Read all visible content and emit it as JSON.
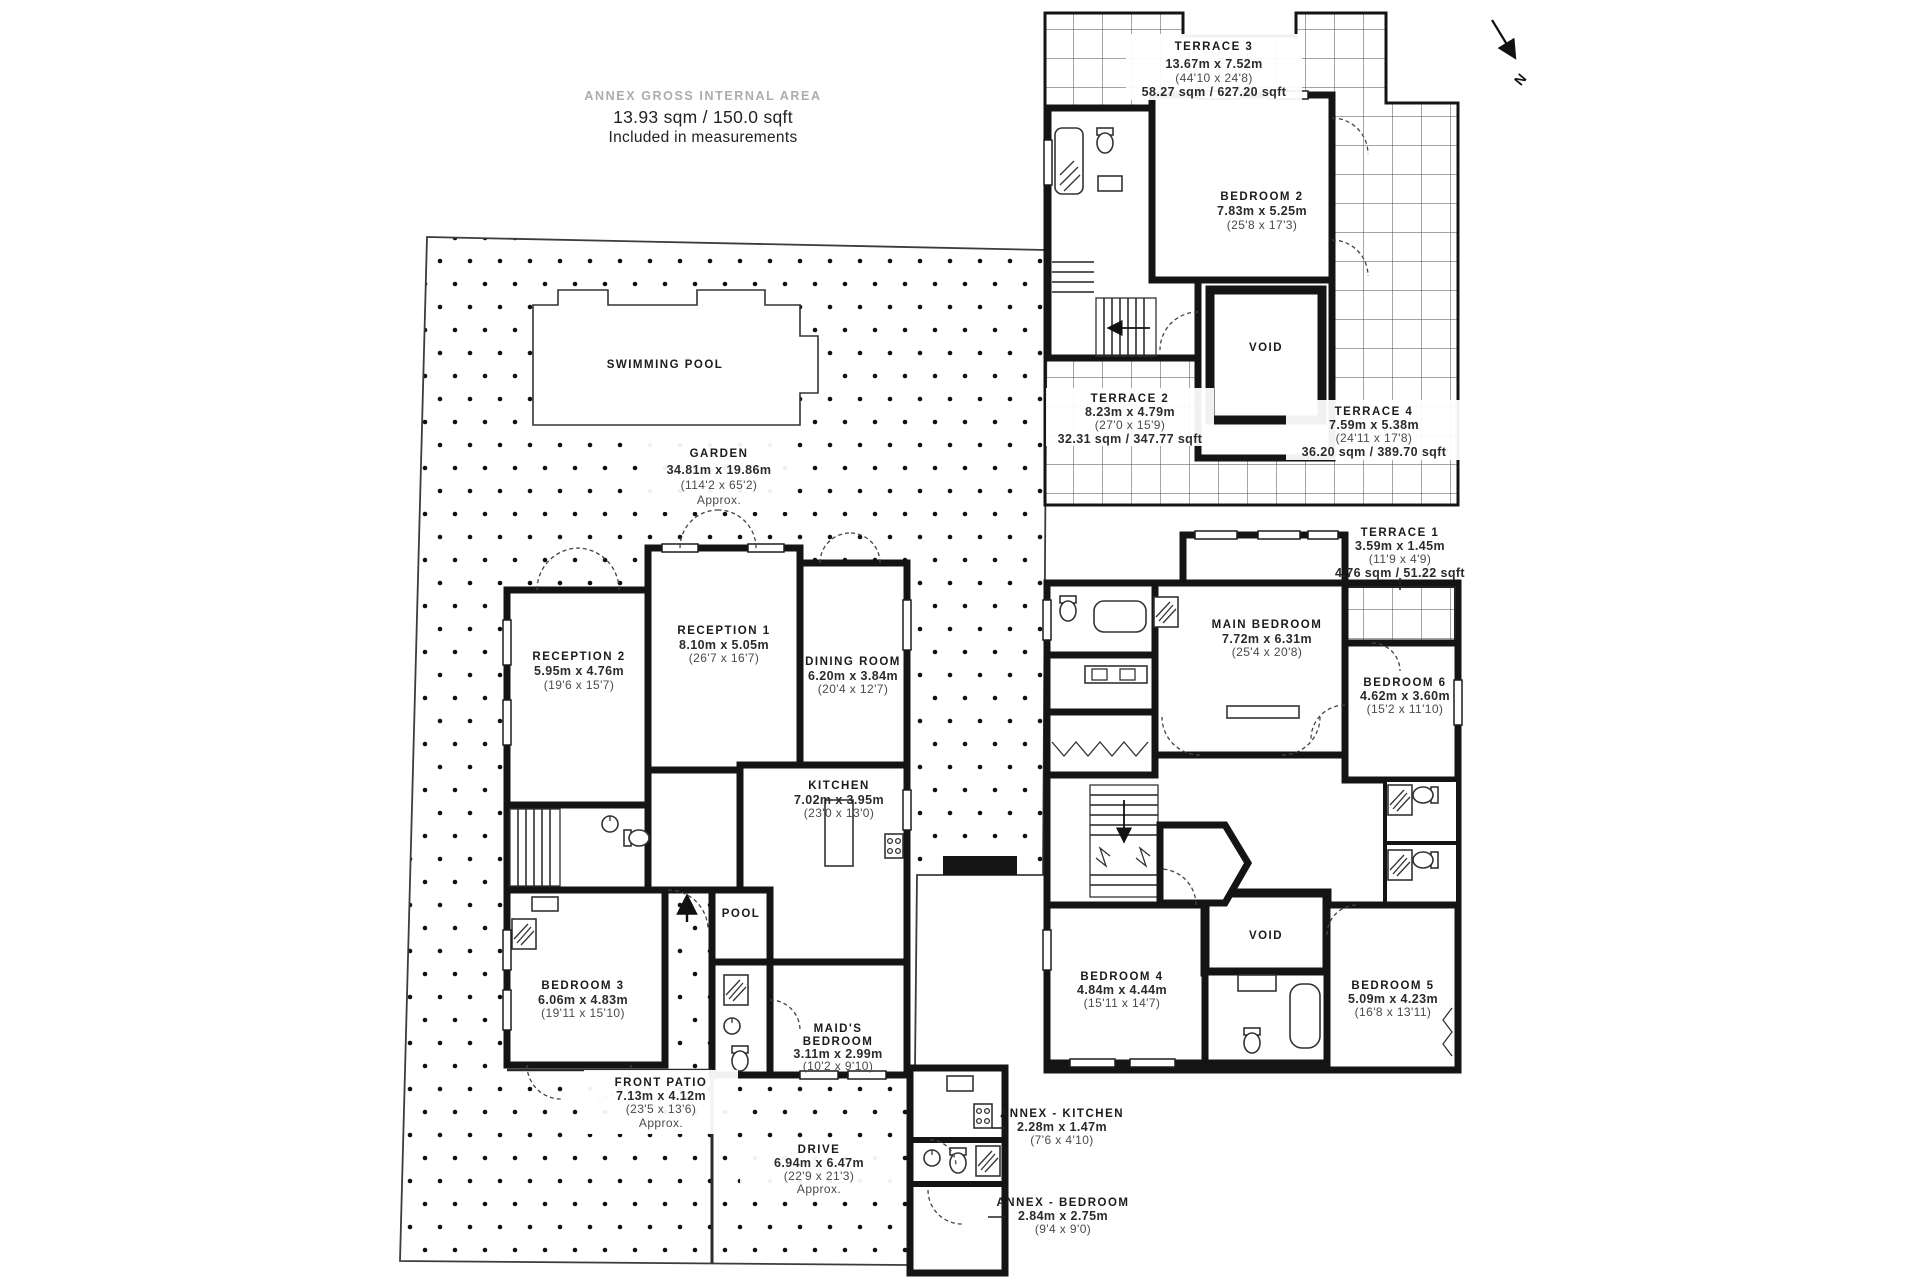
{
  "header": {
    "label": "ANNEX GROSS INTERNAL AREA",
    "value": "13.93 sqm / 150.0 sqft",
    "note": "Included in measurements"
  },
  "compass": {
    "north_label": "N"
  },
  "floors": {
    "ground": {
      "garden": {
        "name": "GARDEN",
        "dims_m": "34.81m x 19.86m",
        "dims_ft": "(114'2 x 65'2)",
        "note": "Approx."
      },
      "swimming_pool": {
        "name": "SWIMMING POOL"
      },
      "reception_1": {
        "name": "RECEPTION 1",
        "dims_m": "8.10m x 5.05m",
        "dims_ft": "(26'7 x 16'7)"
      },
      "reception_2": {
        "name": "RECEPTION 2",
        "dims_m": "5.95m x 4.76m",
        "dims_ft": "(19'6 x 15'7)"
      },
      "dining_room": {
        "name": "DINING ROOM",
        "dims_m": "6.20m x 3.84m",
        "dims_ft": "(20'4 x 12'7)"
      },
      "kitchen": {
        "name": "KITCHEN",
        "dims_m": "7.02m x 3.95m",
        "dims_ft": "(23'0 x 13'0)"
      },
      "pool_room": {
        "name": "POOL"
      },
      "bedroom_3": {
        "name": "BEDROOM 3",
        "dims_m": "6.06m x 4.83m",
        "dims_ft": "(19'11 x 15'10)"
      },
      "maids_bedroom": {
        "name_line1": "MAID'S",
        "name_line2": "BEDROOM",
        "dims_m": "3.11m x 2.99m",
        "dims_ft": "(10'2 x 9'10)"
      },
      "front_patio": {
        "name": "FRONT PATIO",
        "dims_m": "7.13m x 4.12m",
        "dims_ft": "(23'5 x 13'6)",
        "note": "Approx."
      },
      "drive": {
        "name": "DRIVE",
        "dims_m": "6.94m x 6.47m",
        "dims_ft": "(22'9 x 21'3)",
        "note": "Approx."
      },
      "annex_kitchen": {
        "name": "ANNEX - KITCHEN",
        "dims_m": "2.28m x 1.47m",
        "dims_ft": "(7'6 x 4'10)"
      },
      "annex_bedroom": {
        "name": "ANNEX - BEDROOM",
        "dims_m": "2.84m x 2.75m",
        "dims_ft": "(9'4 x 9'0)"
      }
    },
    "first": {
      "terrace_3": {
        "name": "TERRACE 3",
        "dims_m": "13.67m x 7.52m",
        "dims_ft": "(44'10 x 24'8)",
        "area": "58.27 sqm / 627.20 sqft"
      },
      "bedroom_2": {
        "name": "BEDROOM 2",
        "dims_m": "7.83m x 5.25m",
        "dims_ft": "(25'8 x 17'3)"
      },
      "void": {
        "name": "VOID"
      },
      "terrace_2": {
        "name": "TERRACE 2",
        "dims_m": "8.23m x 4.79m",
        "dims_ft": "(27'0 x 15'9)",
        "area": "32.31 sqm / 347.77 sqft"
      },
      "terrace_4": {
        "name": "TERRACE 4",
        "dims_m": "7.59m x 5.38m",
        "dims_ft": "(24'11 x 17'8)",
        "area": "36.20 sqm / 389.70 sqft"
      }
    },
    "second": {
      "terrace_1": {
        "name": "TERRACE 1",
        "dims_m": "3.59m x 1.45m",
        "dims_ft": "(11'9 x 4'9)",
        "area": "4.76 sqm / 51.22 sqft"
      },
      "main_bedroom": {
        "name": "MAIN BEDROOM",
        "dims_m": "7.72m x 6.31m",
        "dims_ft": "(25'4 x 20'8)"
      },
      "bedroom_6": {
        "name": "BEDROOM 6",
        "dims_m": "4.62m x 3.60m",
        "dims_ft": "(15'2 x 11'10)"
      },
      "bedroom_4": {
        "name": "BEDROOM 4",
        "dims_m": "4.84m x 4.44m",
        "dims_ft": "(15'11 x 14'7)"
      },
      "bedroom_5": {
        "name": "BEDROOM 5",
        "dims_m": "5.09m x 4.23m",
        "dims_ft": "(16'8 x 13'11)"
      },
      "void": {
        "name": "VOID"
      }
    }
  }
}
